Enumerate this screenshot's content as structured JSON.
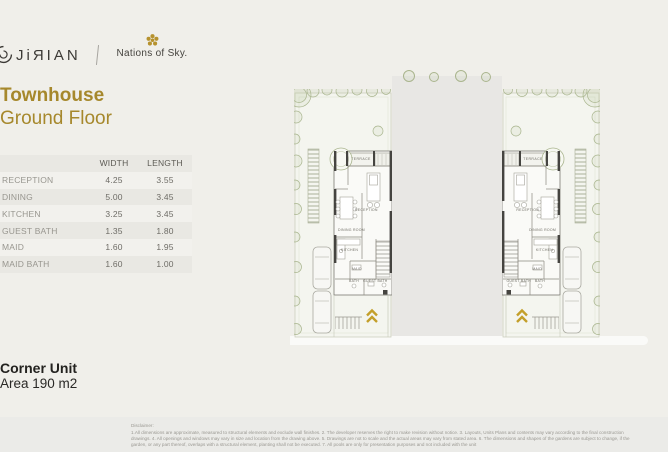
{
  "header": {
    "brand": "JiЯIAN",
    "partner": "Nations of Sky."
  },
  "title": {
    "line1": "Townhouse",
    "line2": "Ground Floor"
  },
  "dimensions_table": {
    "col_width": "WIDTH",
    "col_length": "LENGTH",
    "rows": [
      {
        "room": "RECEPTION",
        "width": "4.25",
        "length": "3.55"
      },
      {
        "room": "DINING",
        "width": "5.00",
        "length": "3.45"
      },
      {
        "room": "KITCHEN",
        "width": "3.25",
        "length": "3.45"
      },
      {
        "room": "GUEST BATH",
        "width": "1.35",
        "length": "1.80"
      },
      {
        "room": "MAID",
        "width": "1.60",
        "length": "1.95"
      },
      {
        "room": "MAID BATH",
        "width": "1.60",
        "length": "1.00"
      }
    ]
  },
  "unit_info": {
    "name": "Corner Unit",
    "area": "Area 190 m2"
  },
  "plan": {
    "labels": {
      "terrace": "TERRACE",
      "reception": "RECEPTION",
      "dining": "DINING ROOM",
      "kitchen": "KITCHEN",
      "maid": "MAID",
      "bath": "BATH",
      "guest_bath": "GUEST BATH"
    }
  },
  "disclaimer": {
    "heading": "Disclaimer:",
    "body": "1.All dimensions are approximate, measured to structural elements and exclude wall finishes.  2. The developer reserves the right to make revision without notice.  3. Layouts, Units Plans and contents may vary according to the final construction drawings.  4. All openings and windows may vary in size and location from the drawing above. 5. Drawings are not to scale and the actual areas may vary from stated area.  6. The dimensions and shapes of the gardens are subject to change, if the garden, or any part thereof, overlaps with a structural element, planting shall not be executed.  7. All pools are only for presentation purposes and not included with the unit"
  },
  "colors": {
    "accent_gold": "#a6882c",
    "chevron_gold": "#c39f2b",
    "flower_gold": "#b6922e",
    "road_gray": "#e8e7e4",
    "page_background": "#f0efea"
  }
}
